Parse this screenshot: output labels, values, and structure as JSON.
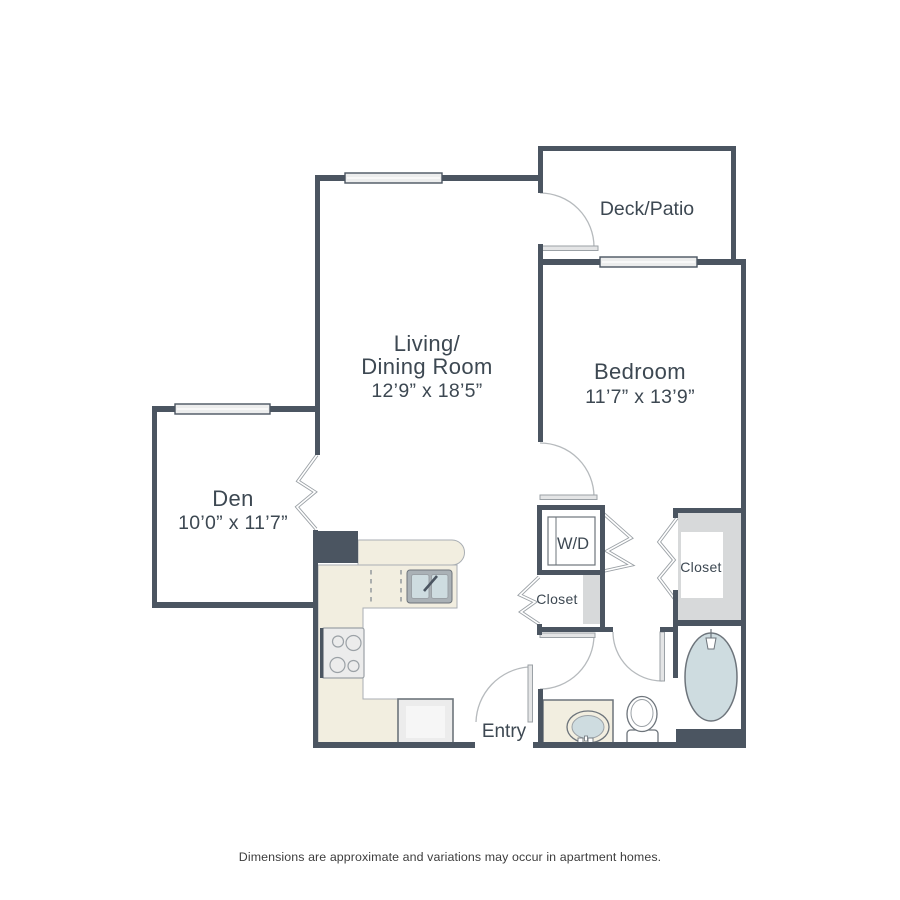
{
  "rooms": {
    "deck": {
      "name": "Deck/Patio"
    },
    "living": {
      "line1": "Living/",
      "line2": "Dining Room",
      "dims": "12’9” x 18’5”"
    },
    "bedroom": {
      "name": "Bedroom",
      "dims": "11’7” x 13’9”"
    },
    "den": {
      "name": "Den",
      "dims": "10’0” x 11’7”"
    },
    "laundry": {
      "label": "W/D"
    },
    "hall_closet": {
      "label": "Closet"
    },
    "bedroom_closet": {
      "label": "Closet"
    },
    "entry": {
      "label": "Entry"
    }
  },
  "footer": {
    "disclaimer": "Dimensions are approximate and variations may occur in apartment homes."
  },
  "colors": {
    "wall": "#4b5561",
    "arcLine": "#b6babd",
    "doorLeaf": "#e4e5e6",
    "doorEdge": "#9ba1a6",
    "windowFill": "#eceded",
    "counter": "#f2eee0",
    "counterEdge": "#a9aeb3",
    "shade": "#d7d9da",
    "water": "#cedce0",
    "fixtureEdge": "#6d747b",
    "fixtureLight": "#ececec",
    "labelInk": "#3d4852",
    "footerInk": "#3d3d3d"
  }
}
